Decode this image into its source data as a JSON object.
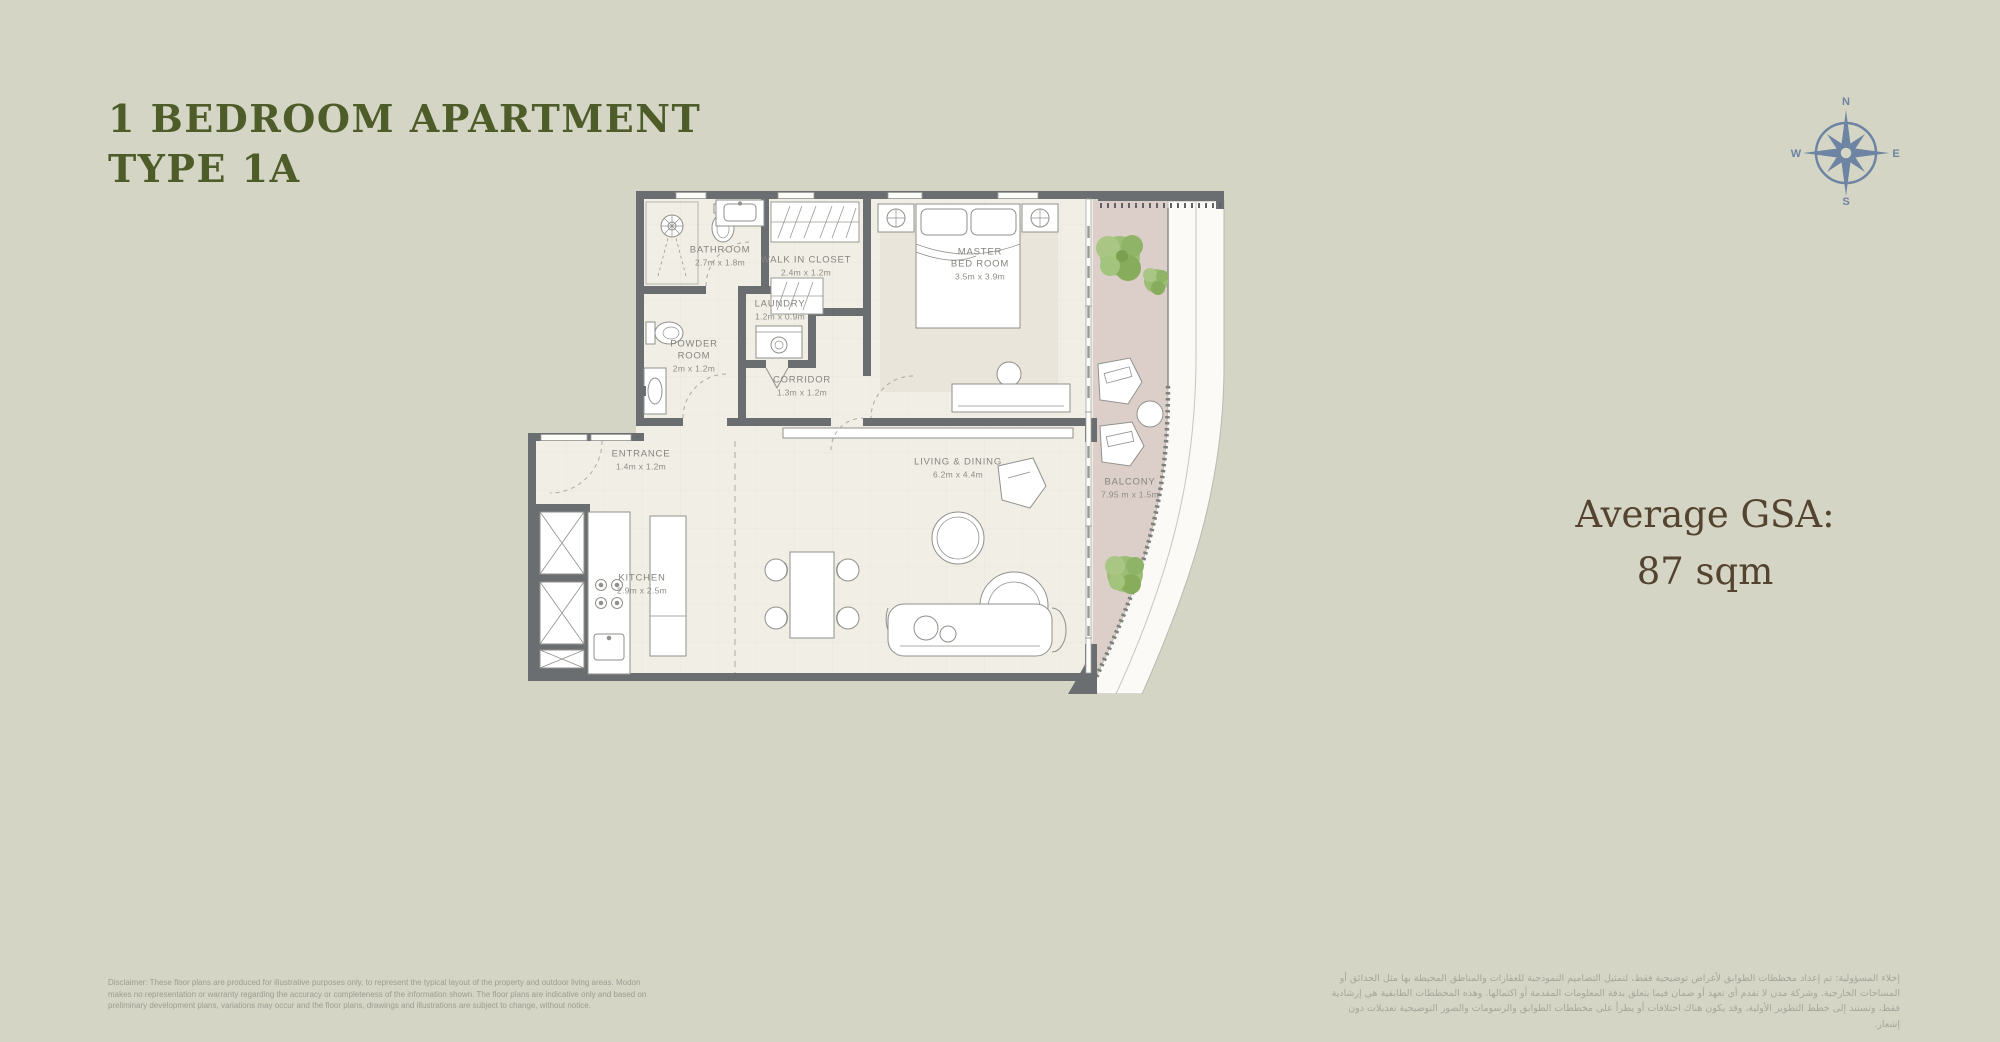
{
  "header": {
    "title_line1": "1 BEDROOM APARTMENT",
    "title_line2": "TYPE 1A"
  },
  "compass": {
    "n": "N",
    "e": "E",
    "s": "S",
    "w": "W"
  },
  "gsa": {
    "line1": "Average GSA:",
    "line2": "87 sqm"
  },
  "rooms": [
    {
      "id": "bathroom",
      "name": "BATHROOM",
      "dims": "2.7m x 1.8m"
    },
    {
      "id": "walk-in-closet",
      "name": "WALK IN CLOSET",
      "dims": "2.4m x 1.2m"
    },
    {
      "id": "master-bedroom",
      "name": "MASTER\nBED ROOM",
      "dims": "3.5m x 3.9m"
    },
    {
      "id": "laundry",
      "name": "LAUNDRY",
      "dims": "1.2m x 0.9m"
    },
    {
      "id": "powder-room",
      "name": "POWDER\nROOM",
      "dims": "2m x 1.2m"
    },
    {
      "id": "corridor",
      "name": "CORRIDOR",
      "dims": "1.3m x 1.2m"
    },
    {
      "id": "entrance",
      "name": "ENTRANCE",
      "dims": "1.4m x 1.2m"
    },
    {
      "id": "kitchen",
      "name": "KITCHEN",
      "dims": "2.9m x 2.5m"
    },
    {
      "id": "living-dining",
      "name": "LIVING & DINING",
      "dims": "6.2m x 4.4m"
    },
    {
      "id": "balcony",
      "name": "BALCONY",
      "dims": "7.95 m x 1.5m"
    }
  ],
  "disclaimer_en": "Disclaimer: These floor plans are produced for illustrative purposes only, to represent the typical layout of the property and outdoor living areas.  Modon makes no representation or warranty regarding the accuracy or completeness of the information shown.  The floor plans are indicative only and based on preliminary development plans, variations may occur and the floor plans, drawings and illustrations are subject to change, without notice.",
  "disclaimer_ar": "إخلاء المسؤولية: تم إعداد مخططات الطوابق لأغراض توضيحية فقط، لتمثيل التصاميم النموذجية للعقارات والمناطق المحيطة بها مثل الحدائق أو المساحات الخارجية. وشركة مدن لا تقدم أي تعهد أو ضمان فيما يتعلق بدقة المعلومات المقدمة أو اكتمالها. وهذه المخططات الطابقية هي إرشادية فقط، وتستند إلى خطط التطوير الأولية، وقد يكون هناك اختلافات أو يطرأ على مخططات الطوابق والرسومات والصور التوضيحية تعديلات دون إشعار.",
  "colors": {
    "background": "#d4d5c5",
    "title": "#4d5c29",
    "gsa_text": "#54432e",
    "compass": "#6d84a2",
    "walls": "#6b6e71",
    "floor": "#f1eee6",
    "balcony_floor": "#dccfca",
    "tree_green": "#8fb468"
  }
}
